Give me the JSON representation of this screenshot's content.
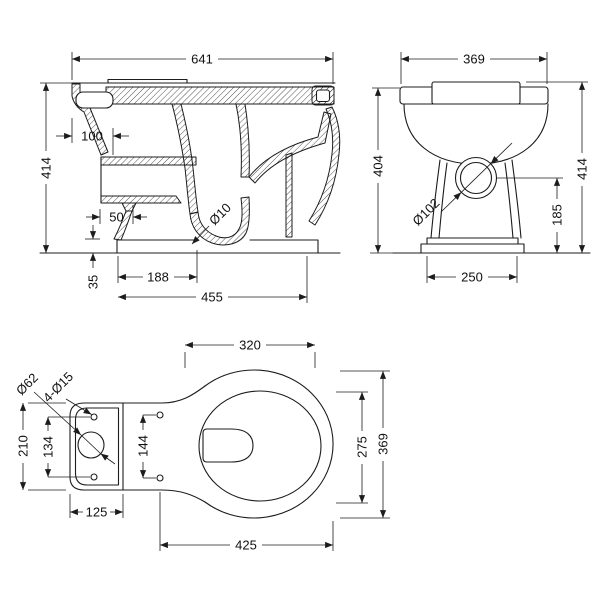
{
  "drawing_title": "Toilet pan dimension drawing",
  "side_view": {
    "overall_length": "641",
    "overall_height": "414",
    "inlet_projection": "100",
    "outlet_offset": "50",
    "plinth_height": "35",
    "outlet_center": "188",
    "base_depth": "455",
    "trap_hole": "Ø10"
  },
  "front_view": {
    "overall_width": "369",
    "rim_height": "404",
    "overall_height": "414",
    "outlet_diameter": "Ø102",
    "outlet_center_height": "185",
    "base_width": "250"
  },
  "plan_view": {
    "bowl_inner_width": "320",
    "inlet_hole_diameter": "Ø62",
    "fixing_holes": "4-Ø15",
    "platform_depth": "210",
    "platform_hole_spacing": "134",
    "seat_hole_spacing": "144",
    "platform_width": "125",
    "bowl_inner_depth": "275",
    "bowl_outer_depth": "369",
    "bowl_projection": "425"
  },
  "colors": {
    "line": "#1c1c1c",
    "background": "#ffffff"
  }
}
